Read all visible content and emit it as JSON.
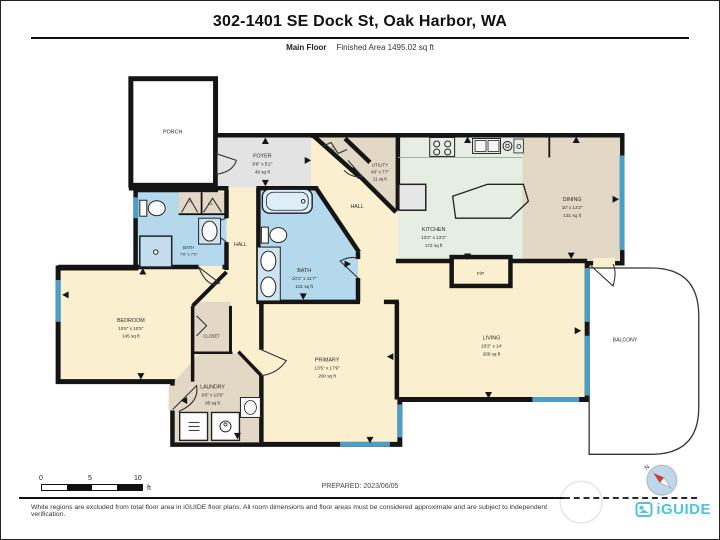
{
  "header": {
    "title": "302-1401 SE Dock St, Oak Harbor, WA",
    "floor_label": "Main Floor",
    "area_label": "Finished Area 1495.02 sq ft"
  },
  "rooms": {
    "porch": {
      "name": "PORCH"
    },
    "foyer": {
      "name": "FOYER",
      "dims": "9'6\" x 5'2\"",
      "area": "49 sq ft"
    },
    "closet_hall": {
      "name": "CL"
    },
    "utility": {
      "name": "UTILITY",
      "dims": "4'6\" x 7'7\"",
      "area": "21 sq ft"
    },
    "hall_upper": {
      "name": "HALL"
    },
    "kitchen": {
      "name": "KITCHEN",
      "dims": "13'2\" x 13'2\"",
      "area": "172 sq ft"
    },
    "dining": {
      "name": "DINING",
      "dims": "10' x 13'2\"",
      "area": "131 sq ft"
    },
    "bath_hall": {
      "name": "BATH",
      "dims": "7'8\" x 7'9\""
    },
    "closet_c": {
      "name": "C"
    },
    "closet_cl": {
      "name": "CL"
    },
    "hall_lower": {
      "name": "HALL"
    },
    "bath_primary": {
      "name": "BATH",
      "dims": "10'1\" x 11'7\"",
      "area": "101 sq ft"
    },
    "bedroom": {
      "name": "BEDROOM",
      "dims": "15'6\" x 10'5\"",
      "area": "145 sq ft"
    },
    "closet_bedroom": {
      "name": "CLOSET"
    },
    "primary": {
      "name": "PRIMARY",
      "dims": "13'5\" x 17'9\"",
      "area": "200 sq ft"
    },
    "laundry": {
      "name": "LAUNDRY",
      "dims": "8'6\" x 13'9\"",
      "area": "85 sq ft"
    },
    "living": {
      "name": "LIVING",
      "dims": "19'2\" x 14'",
      "area": "268 sq ft"
    },
    "balcony": {
      "name": "BALCONY"
    },
    "fireplace": {
      "name": "F/P"
    }
  },
  "scale_bar": {
    "tick0": "0",
    "tick5": "5",
    "tick10": "10",
    "unit": "ft"
  },
  "prepared": "PREPARED: 2023/06/05",
  "compass": {
    "label": "N"
  },
  "footer": {
    "disclaimer": "White regions are excluded from total floor area in iGUIDE floor plans. All room dimensions and floor areas must be considered approximate and are subject to independent verification.",
    "brand": "iGUIDE"
  },
  "colors": {
    "wall": "#151515",
    "room_cream": "#faf0cf",
    "room_tan": "#e2d8c5",
    "room_gray": "#e3e3e3",
    "room_kitchen": "#e6eee4",
    "room_bath": "#b4d8ec",
    "window": "#4c9dc7",
    "brand_teal": "#4ec3de",
    "compass_red": "#d2382c"
  }
}
